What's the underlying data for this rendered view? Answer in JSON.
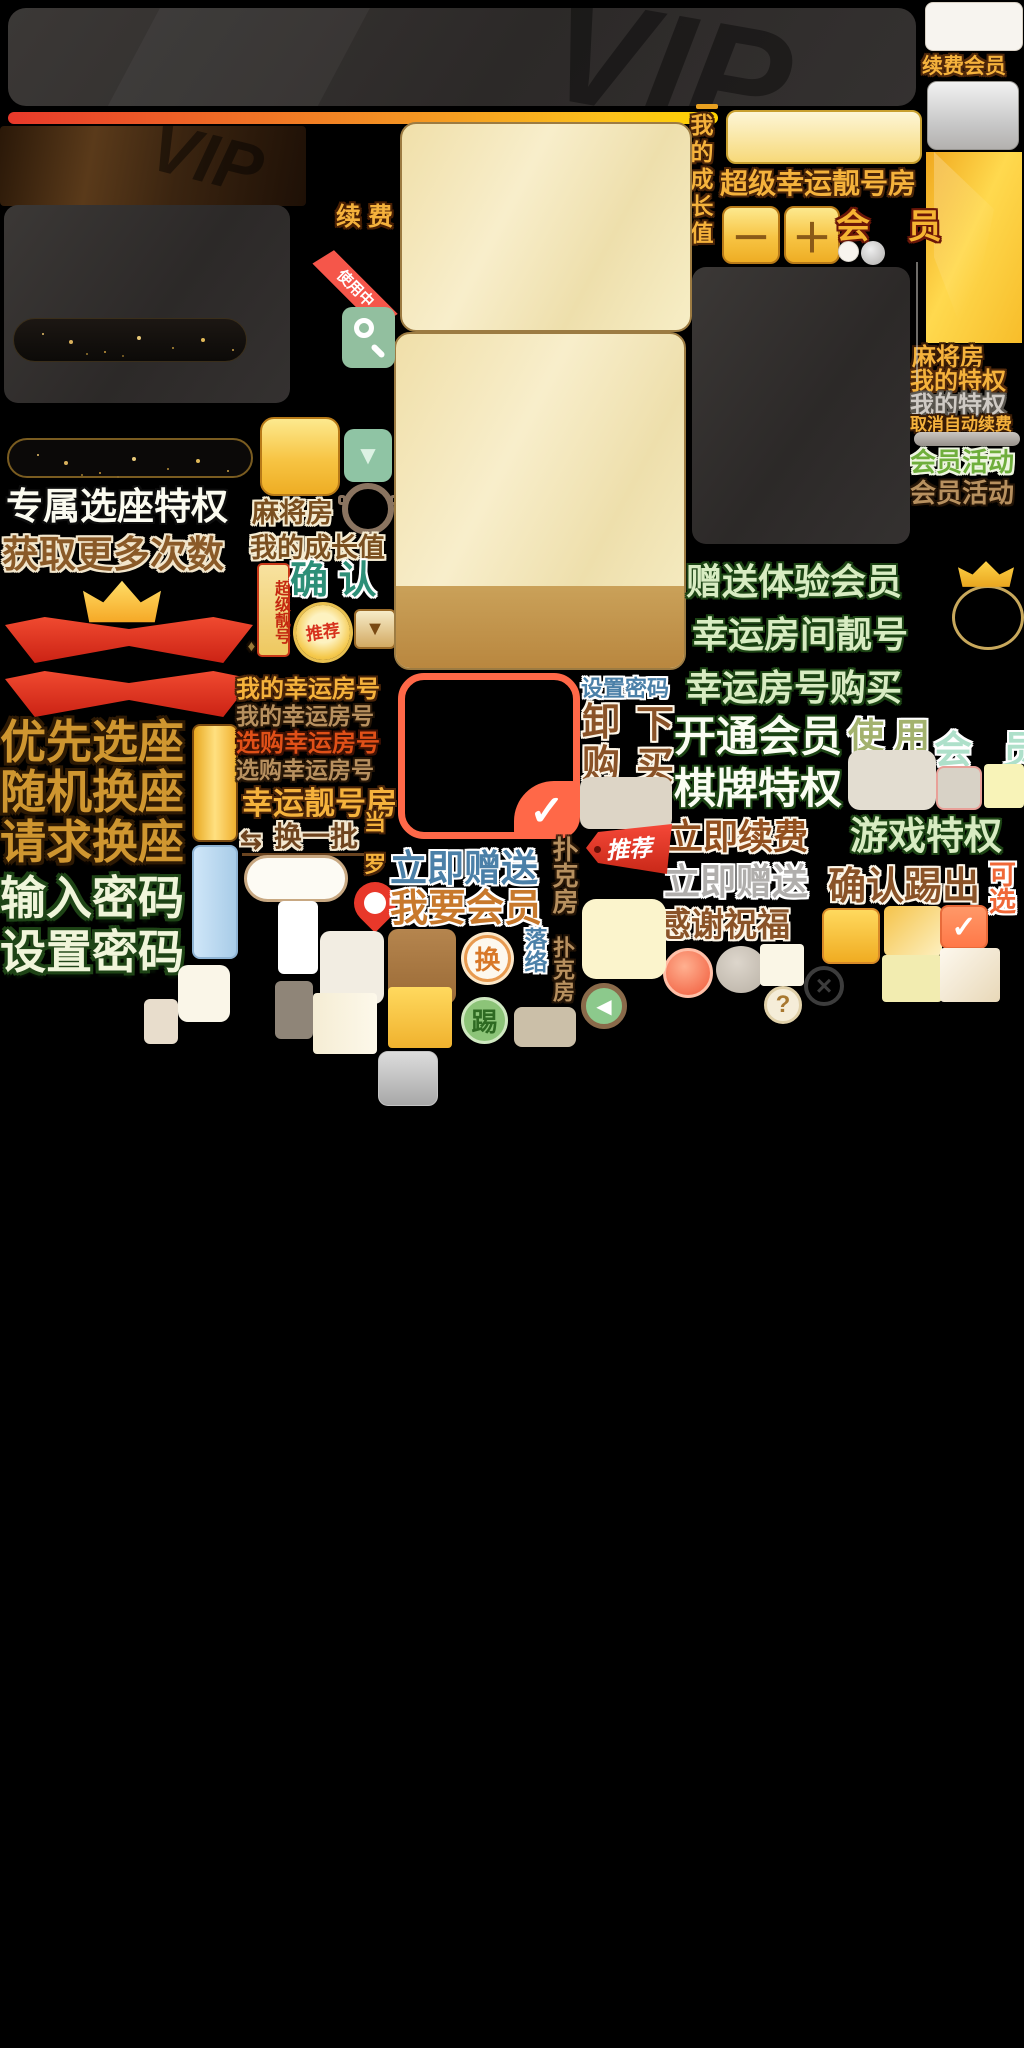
{
  "meta": {
    "title": "Mahjong/poker game VIP membership UI sprite atlas",
    "canvas": {
      "width": 1024,
      "height": 2048
    },
    "accent_colors": {
      "gold": "#f5b23c",
      "deep_gold": "#eead24",
      "red_ribbon": "#e0301e",
      "teal_button": "#8fc4a4",
      "cream_panel": "#f6e9c0",
      "steel_blue": "#4b80a8",
      "dark_green_outline": "#1c4414",
      "salmon": "#ff7848"
    }
  },
  "labels": {
    "renew_vip": "续费会员",
    "mahjong_room": "麻将房",
    "my_privilege": "我的特权",
    "cancel_auto_renew": "取消自动续费",
    "vip_activity": "会员活动",
    "exclusive_seat": "专属选座特权",
    "get_more_times": "获取更多次数",
    "priority_seat": "优先选座",
    "random_seat": "随机换座",
    "request_seat": "请求换座",
    "enter_password": "输入密码",
    "set_password": "设置密码",
    "renew": "续 费",
    "in_use": "使用中",
    "my_growth": "我的成长值",
    "super_nick": "超级靓号",
    "confirm": "确 认",
    "recommend": "推荐",
    "my_lucky_room": "我的幸运房号",
    "buy_lucky_room": "选购幸运房号",
    "lucky_nick_room": "幸运靓号房",
    "change_batch": "换一批",
    "super_lucky_room": "超级幸运靓号房",
    "vip": "会 员",
    "gift_trial_vip": "赠送体验会员",
    "lucky_room_nick": "幸运房间靓号",
    "lucky_room_buy": "幸运房号购买",
    "open_vip": "开通会员",
    "use": "使 用",
    "board_privilege": "棋牌特权",
    "renew_now": "立即续费",
    "game_privilege": "游戏特权",
    "gift_now": "立即赠送",
    "confirm_kick": "确认踢出",
    "optional": "可选",
    "thanks_bless": "感谢祝福",
    "unload": "卸",
    "purchase": "购",
    "down": "下",
    "buy": "买",
    "want_vip": "我要会员",
    "poker_room": "扑克房",
    "swap": "换",
    "kick": "踢",
    "blue_vertical_chars": "落络",
    "gold_char_1": "当",
    "gold_char_2": "罗"
  },
  "glyphs": {
    "vip_watermark": "VIP",
    "triangle_down": "▼",
    "minus": "－",
    "plus": "＋",
    "check": "✓",
    "left_arrow": "◀",
    "close": "×",
    "question": "?",
    "diamond": "♦",
    "swap_arrows": "⇆"
  }
}
